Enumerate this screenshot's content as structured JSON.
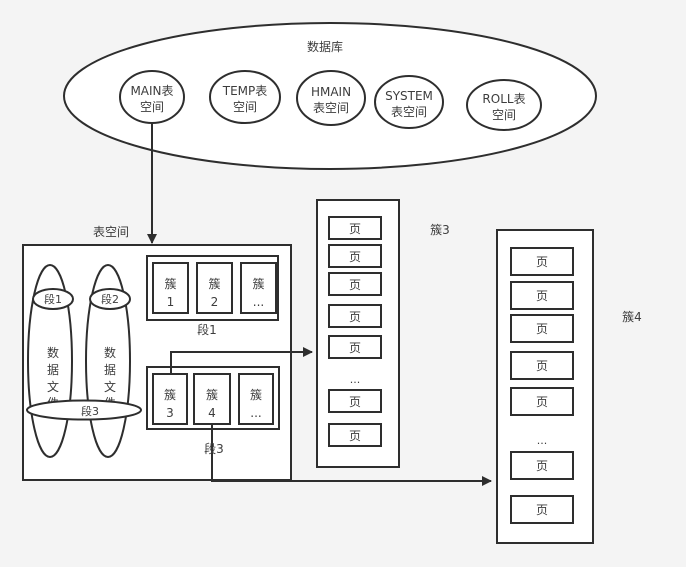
{
  "colors": {
    "background": "#f4f4f4",
    "stroke": "#2e2e2e",
    "text": "#3d3d3d",
    "fill": "#ffffff"
  },
  "database": {
    "label": "数据库",
    "tablespaces": [
      {
        "line1": "MAIN表",
        "line2": "空间"
      },
      {
        "line1": "TEMP表",
        "line2": "空间"
      },
      {
        "line1": "HMAIN",
        "line2": "表空间"
      },
      {
        "line1": "SYSTEM",
        "line2": "表空间"
      },
      {
        "line1": "ROLL表",
        "line2": "空间"
      }
    ]
  },
  "tablespace": {
    "label": "表空间",
    "datafile_text": [
      "数",
      "据",
      "文",
      "件"
    ],
    "segments": {
      "seg1": "段1",
      "seg2": "段2",
      "seg3": "段3"
    },
    "extent_groups": [
      {
        "label": "段1",
        "extents": [
          {
            "top": "簇",
            "bottom": "1"
          },
          {
            "top": "簇",
            "bottom": "2"
          },
          {
            "top": "簇",
            "bottom": "..."
          }
        ]
      },
      {
        "label": "段3",
        "extents": [
          {
            "top": "簇",
            "bottom": "3"
          },
          {
            "top": "簇",
            "bottom": "4"
          },
          {
            "top": "簇",
            "bottom": "..."
          }
        ]
      }
    ]
  },
  "page_panels": [
    {
      "label": "簇3",
      "pages_top": [
        "页",
        "页",
        "页",
        "页",
        "页"
      ],
      "ellipsis": "...",
      "pages_bottom": [
        "页",
        "页"
      ]
    },
    {
      "label": "簇4",
      "pages_top": [
        "页",
        "页",
        "页",
        "页",
        "页"
      ],
      "ellipsis": "...",
      "pages_bottom": [
        "页",
        "页"
      ]
    }
  ]
}
